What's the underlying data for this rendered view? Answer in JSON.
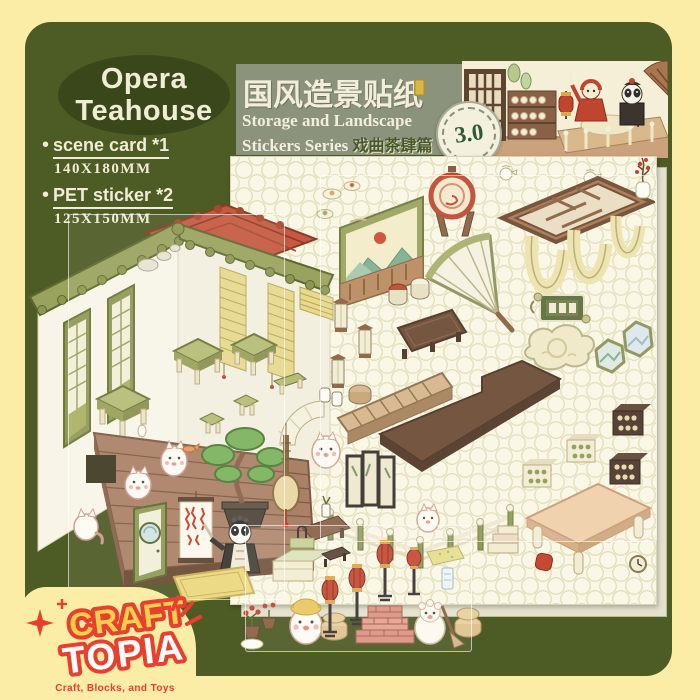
{
  "product": {
    "title_line1": "Opera",
    "title_line2": "Teahouse",
    "specs": [
      {
        "label": "scene card *1",
        "size": "140X180MM"
      },
      {
        "label": "PET sticker *2",
        "size": "125X150MM"
      }
    ]
  },
  "header": {
    "title_cn": "国风造景贴纸",
    "subtitle_line1": "Storage and Landscape",
    "subtitle_line2": "Stickers Series",
    "subtitle_line2_cn": "戏曲茶肆篇",
    "version": "3.0"
  },
  "brand": {
    "name_top": "CRAFT",
    "name_bottom": "TOPIA",
    "tagline": "Craft, Blocks, and Toys"
  },
  "colors": {
    "frame_yellow": "#fbeda5",
    "panel_olive": "#4d5b24",
    "title_ellipse_green": "#39471b",
    "cream_text": "#f1ecd6",
    "header_band": "#8b937c",
    "sheet_cream": "#faf7e6",
    "roof_green": "#9aa35d",
    "roof_red": "#c65a40",
    "accent_red": "#c0452f",
    "logo_red": "#e8402f",
    "logo_yellow": "#f8cf4d"
  }
}
